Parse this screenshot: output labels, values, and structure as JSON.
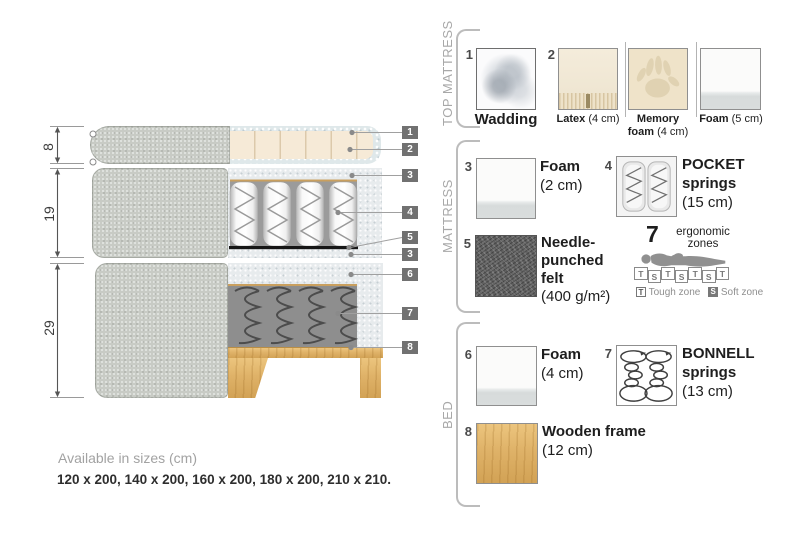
{
  "colors": {
    "fabric_grey": "#c8cbc5",
    "casing_grey": "#e7ebed",
    "wadding_blue_grey": "#dfe8ea",
    "latex_cream": "#f6ead7",
    "wood": "#dfb268",
    "felt_dark": "#5f5f5f",
    "badge_grey": "#717171",
    "spring_dark": "#4c4c4c",
    "tan_line": "#c99f5e"
  },
  "diagram": {
    "dims": [
      "8",
      "19",
      "29"
    ],
    "callouts": [
      "1",
      "2",
      "3",
      "4",
      "5",
      "3",
      "6",
      "7",
      "8"
    ]
  },
  "legend": {
    "top": {
      "title": "TOP MATTRESS",
      "num1": "1",
      "wadding": "Wadding",
      "num2": "2",
      "latex_b": "Latex",
      "latex_r": "(4 cm)",
      "memory_b1": "Memory",
      "memory_b2": "foam",
      "memory_r": "(4 cm)",
      "foam_b": "Foam",
      "foam_r": "(5 cm)"
    },
    "mattress": {
      "title": "MATTRESS",
      "num3": "3",
      "foam_b": "Foam",
      "foam_r": "(2 cm)",
      "num4": "4",
      "pocket_b1": "POCKET",
      "pocket_b2": "springs",
      "pocket_r": "(15 cm)",
      "num5": "5",
      "felt_b1": "Needle-",
      "felt_b2": "punched",
      "felt_b3": "felt",
      "felt_r": "(400 g/m²)",
      "zones": {
        "num": "7",
        "line1": "ergonomic",
        "line2": "zones",
        "cells": [
          "T",
          "S",
          "T",
          "S",
          "T",
          "S",
          "T"
        ],
        "legend_t_key": "T",
        "legend_t": "Tough zone",
        "legend_s_key": "S",
        "legend_s": "Soft zone"
      }
    },
    "bed": {
      "title": "BED",
      "num6": "6",
      "foam_b": "Foam",
      "foam_r": "(4 cm)",
      "num7": "7",
      "bonnell_b1": "BONNELL",
      "bonnell_b2": "springs",
      "bonnell_r": "(13 cm)",
      "num8": "8",
      "wood_b": "Wooden frame",
      "wood_r": "(12 cm)"
    }
  },
  "footer": {
    "title": "Available in sizes (cm)",
    "sizes": "120 x 200, 140 x 200, 160 x 200, 180 x 200, 210 x 210."
  }
}
